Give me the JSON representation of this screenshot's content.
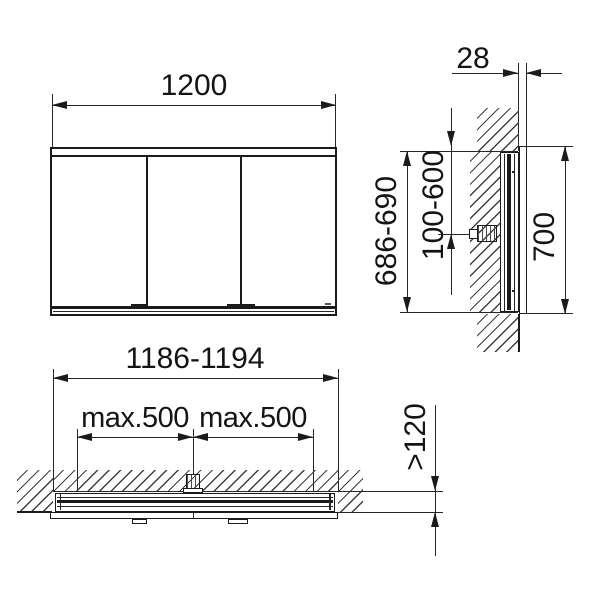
{
  "colors": {
    "background": "#ffffff",
    "line": "#1b1b1b",
    "hatch": "#3f3f3f"
  },
  "views": {
    "front": {
      "dim_width": "1200"
    },
    "side": {
      "dim_protrusion": "28",
      "dim_height_range": "686-690",
      "dim_connection_range": "100-600",
      "dim_height": "700"
    },
    "plan": {
      "dim_width_range": "1186-1194",
      "dim_connection_left": "max.500",
      "dim_connection_right": "max.500",
      "dim_depth_min": ">120"
    }
  }
}
